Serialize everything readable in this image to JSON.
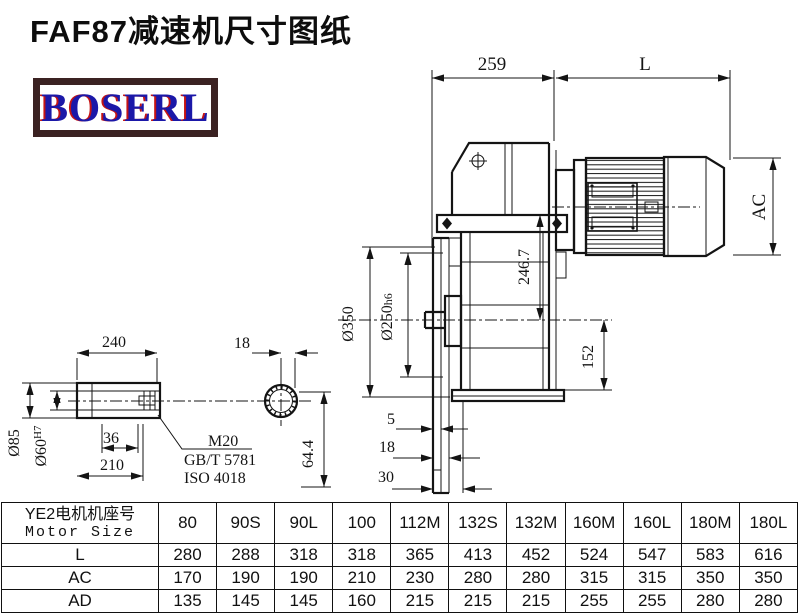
{
  "title": "FAF87减速机尺寸图纸",
  "logo": "BOSERL",
  "colors": {
    "logo_text": "#1b18a8",
    "logo_shadow": "#c41414",
    "logo_border": "#3b2222",
    "line": "#141414"
  },
  "main_view": {
    "dims": {
      "width_259": "259",
      "width_L": "L",
      "ac": "AC",
      "h246": "246.7",
      "dia350": "Ø350",
      "dia250": "Ø250",
      "fit250": "h6",
      "h152": "152",
      "t5": "5",
      "t18": "18",
      "t30": "30"
    }
  },
  "shaft_view": {
    "dims": {
      "length240": "240",
      "ring18": "18",
      "dia85": "Ø85",
      "dia60": "Ø60",
      "fit60": "H7",
      "len36": "36",
      "len210": "210",
      "off644": "64.4"
    },
    "thread": "M20",
    "std_gb": "GB/T 5781",
    "std_iso": "ISO 4018"
  },
  "table": {
    "header_cn": "YE2电机机座号",
    "header_en": "Motor Size",
    "columns": [
      "80",
      "90S",
      "90L",
      "100",
      "112M",
      "132S",
      "132M",
      "160M",
      "160L",
      "180M",
      "180L"
    ],
    "rows": [
      {
        "label": "L",
        "values": [
          "280",
          "288",
          "318",
          "318",
          "365",
          "413",
          "452",
          "524",
          "547",
          "583",
          "616"
        ]
      },
      {
        "label": "AC",
        "values": [
          "170",
          "190",
          "190",
          "210",
          "230",
          "280",
          "280",
          "315",
          "315",
          "350",
          "350"
        ]
      },
      {
        "label": "AD",
        "values": [
          "135",
          "145",
          "145",
          "160",
          "215",
          "215",
          "215",
          "255",
          "255",
          "280",
          "280"
        ]
      }
    ]
  }
}
